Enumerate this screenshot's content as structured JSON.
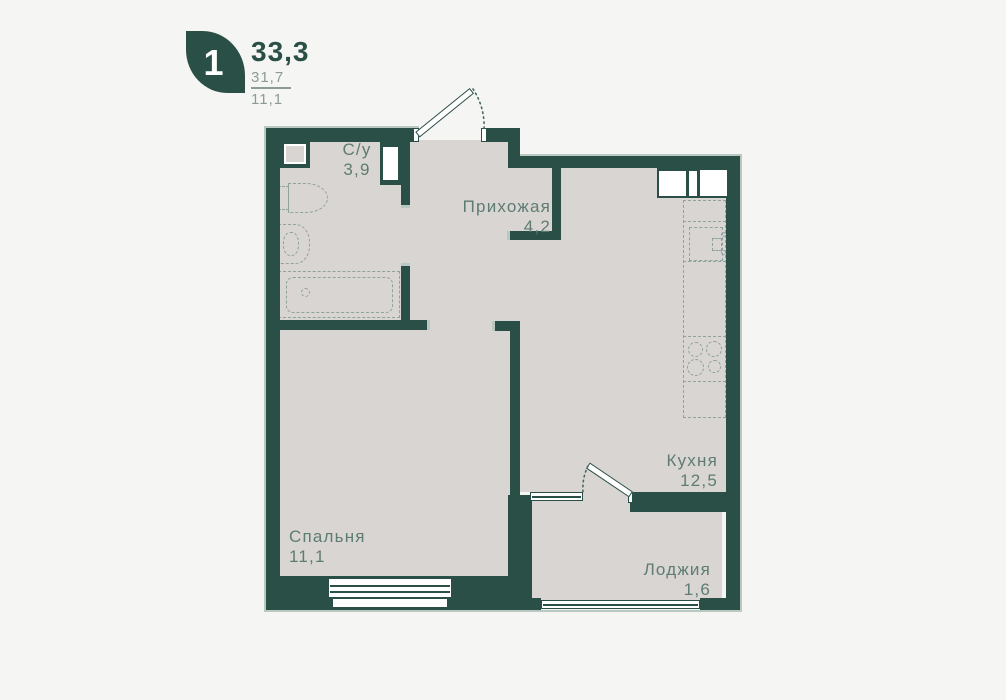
{
  "header": {
    "badge": "1",
    "area_total": "33,3",
    "area_mid": "31,7",
    "area_small": "11,1"
  },
  "rooms": [
    {
      "name": "С/у",
      "area": "3,9"
    },
    {
      "name": "Прихожая",
      "area": "4,2"
    },
    {
      "name": "Кухня",
      "area": "12,5"
    },
    {
      "name": "Спальня",
      "area": "11,1"
    },
    {
      "name": "Лоджия",
      "area": "1,6"
    }
  ],
  "colors": {
    "wall": "#2a4f46",
    "floor": "#d8d5d2",
    "background": "#f5f5f4",
    "label": "#5e7c73",
    "muted": "#8b9c96",
    "fixture": "#8fa29b",
    "accent_light": "#b9c8c1"
  }
}
